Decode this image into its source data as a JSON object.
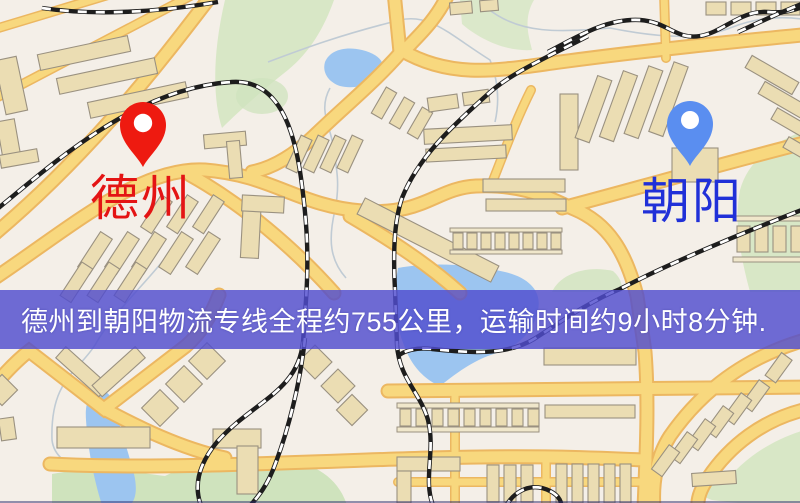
{
  "map": {
    "origin": {
      "label": "德州",
      "pin_color": "#ee1a10",
      "label_color": "#e41414"
    },
    "destination": {
      "label": "朝阳",
      "pin_color": "#5a8ef0",
      "label_color": "#2030d8"
    },
    "banner": {
      "text": "德州到朝阳物流专线全程约755公里，运输时间约9小时8分钟.",
      "bg_color": "rgba(80,77,206,0.82)",
      "text_color": "#ffffff"
    },
    "route": {
      "distance_km": "755",
      "duration": "9小时8分钟"
    },
    "colors": {
      "road": "#f8d87e",
      "road_casing": "#ecb761",
      "water": "#9cc5f0",
      "park": "#d8e7c6",
      "building": "#ebddb3",
      "background": "#f4efe8"
    }
  }
}
